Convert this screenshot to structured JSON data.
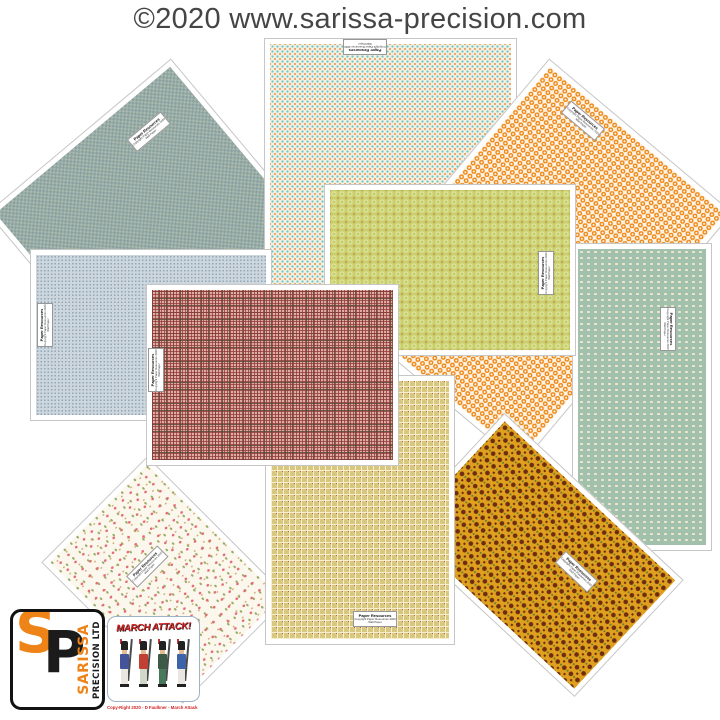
{
  "page": {
    "title": "©2020 www.sarissa-precision.com",
    "title_color": "#454545",
    "background": "#ffffff"
  },
  "sheet_label": {
    "title": "Paper Resources",
    "line2": "Copyright Paper Resources 2020",
    "line3": "Wall Paper"
  },
  "sheets": [
    {
      "id": "green-check",
      "description": "sage green-grey fine check wallpaper sheet, rotated top-left",
      "base": "#a9b8a9",
      "accent": "#87a0a4"
    },
    {
      "id": "teal-dots",
      "description": "cream sheet with aqua and orange dotted grid, top centre",
      "base": "#f4efe6",
      "accent": "#62c9bc",
      "accent2": "#e59a4e"
    },
    {
      "id": "orange-rings",
      "description": "white sheet with orange rings, rotated top-right",
      "base": "#fdf4e6",
      "accent": "#ef8c1f"
    },
    {
      "id": "mint-ovals",
      "description": "sage-mint sheet with cream oval bead rows, right side",
      "base": "#a2c1ad",
      "accent": "#efe6d0"
    },
    {
      "id": "blue-dots",
      "description": "pale blue-grey dotted sheet, left side",
      "base": "#cdd6dd",
      "accent": "#90a7b9"
    },
    {
      "id": "chartreuse",
      "description": "chartreuse sheet with circle motifs and red pin dots, centre",
      "base": "#c9cf6b",
      "accent": "#dfe5a4",
      "accent2": "#c05f52"
    },
    {
      "id": "gold-tiles",
      "description": "gold sheet with dark brown diamond tiles, rotated bottom-right",
      "base": "#dfa01e",
      "accent": "#6d2d12",
      "accent2": "#55803b"
    },
    {
      "id": "floral",
      "description": "cream sheet with pink rosebud floral sprigs, rotated bottom-left",
      "base": "#fbf7ec",
      "accent": "#e26a74",
      "accent2": "#9cab67"
    },
    {
      "id": "tan-weave",
      "description": "tan basket-weave sheet with red squares, bottom centre",
      "base": "#d8c77e",
      "accent": "#f6eecd",
      "accent2": "#b85a4a"
    },
    {
      "id": "red-tartan",
      "description": "red and olive tartan grid sheet, centre-left",
      "base": "#e3aaa2",
      "accent": "#8c3a38",
      "accent2": "#3f4a33"
    }
  ],
  "logos": {
    "sarissa": {
      "letter_s": "S",
      "letter_p": "P",
      "name_line1": "SARISSA",
      "name_line2": "PRECISION LTD",
      "orange": "#ee8318",
      "black": "#1b1b1b"
    },
    "march_attack": {
      "title": "MARCH ATTACK!",
      "copyright": "Copy-Right 2020 - D Faulkner - March Attack",
      "red": "#d42222",
      "soldiers": [
        {
          "coat": "#44549a",
          "trousers": "#e9e7df"
        },
        {
          "coat": "#c23f34",
          "trousers": "#cfd8c9"
        },
        {
          "coat": "#3c5a46",
          "trousers": "#49795c"
        },
        {
          "coat": "#3f63a8",
          "trousers": "#e9e7df"
        }
      ]
    }
  }
}
